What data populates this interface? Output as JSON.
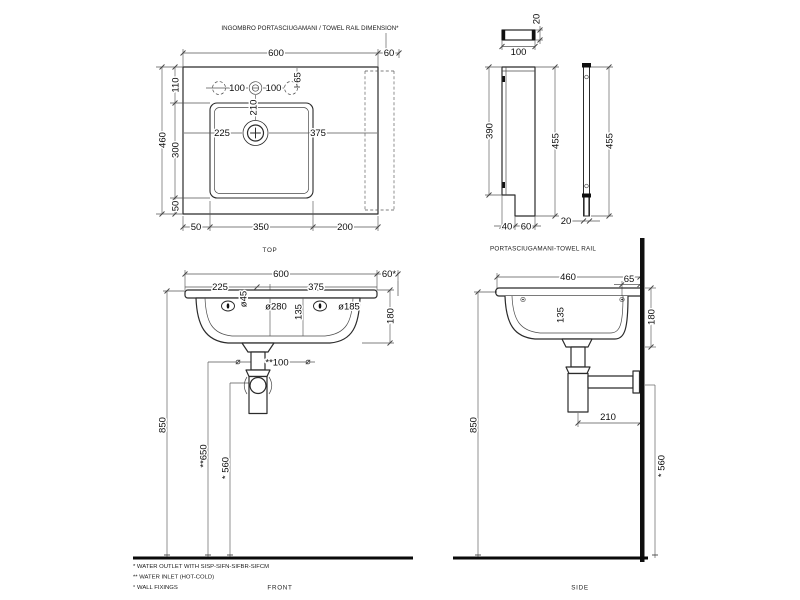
{
  "header": {
    "note": "INGOMBRO PORTASCIUGAMANI / TOWEL RAIL DIMENSION*"
  },
  "colors": {
    "line": "#2b2b2b",
    "accent_black": "#101010",
    "background": "#ffffff"
  },
  "views": {
    "top": {
      "label": "TOP",
      "dims": {
        "overall_width": "600",
        "towel_rail_width": "60",
        "edge_to_basin_top": "110",
        "overall_depth": "460",
        "basin_depth": "300",
        "basin_to_edge_bottom": "50",
        "bottom_left_offset": "50",
        "basin_width": "350",
        "bottom_right_offset": "200",
        "tap_hole_spacing_left": "100",
        "tap_hole_spacing_right": "100",
        "tap_hole_inset": "65",
        "tap_to_drain": "210",
        "drain_from_left": "225",
        "drain_from_right": "375"
      }
    },
    "towel_rail": {
      "label": "PORTASCIUGAMANI-TOWEL RAIL",
      "dims": {
        "bracket_width": "100",
        "bracket_thickness": "20",
        "plate_height": "390",
        "overall_height_side": "455",
        "foot_depth_a": "40",
        "foot_depth_b": "60",
        "overall_height_front": "455",
        "bar_width": "20"
      }
    },
    "front": {
      "label": "FRONT",
      "dims": {
        "overall_width": "600",
        "towel_rail_ext": "60*",
        "drain_from_left": "225",
        "drain_from_right": "375",
        "tap_hole_dia": "ø45",
        "inlet_span": "ø280",
        "basin_inner_depth": "135",
        "overflow_dia": "ø185",
        "apron_height": "180",
        "inlet_spacing": "**100",
        "rim_height": "850",
        "inlet_height": "**650",
        "outlet_height": "* 560"
      }
    },
    "side": {
      "label": "SIDE",
      "dims": {
        "overall_depth": "460",
        "wall_to_hole": "65",
        "basin_inner_depth": "135",
        "apron_height": "180",
        "trap_to_wall": "210",
        "rim_height": "850",
        "outlet_height": "* 560"
      }
    }
  },
  "footnotes": {
    "outlet": "*  WATER OUTLET WITH SISP-SIFN-SIFBR-SIFCM",
    "inlet": "** WATER INLET  (HOT-COLD)",
    "fixings": "°  WALL FIXINGS"
  }
}
